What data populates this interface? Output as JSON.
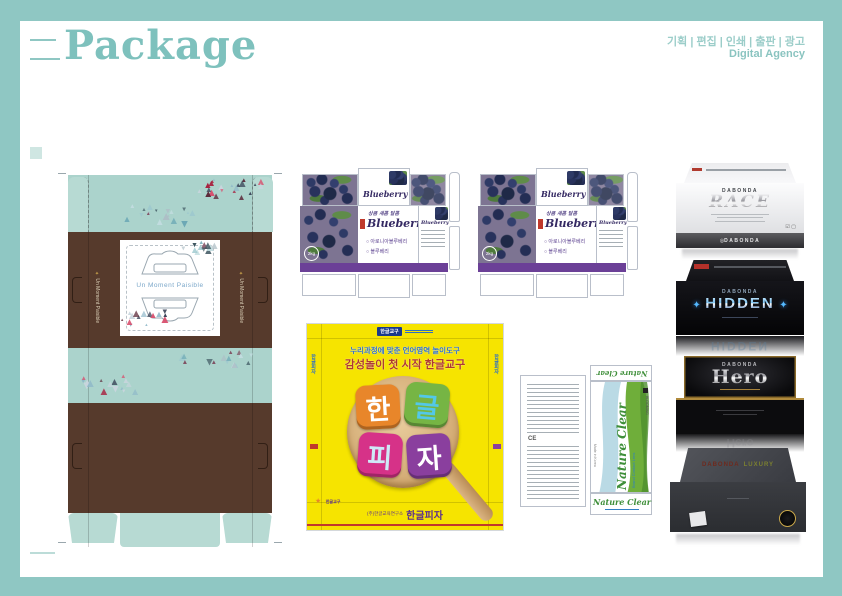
{
  "header": {
    "title": "Package",
    "services": "기획 | 편집 | 인쇄 | 출판 | 광고",
    "agency": "Digital Agency"
  },
  "colors": {
    "frame": "#8fc7c3",
    "title": "#7ec1bd",
    "brown": "#563a2c",
    "teal_panel": "#abd3cc",
    "blueberry_purple": "#6b4097",
    "blueberry_title": "#352a63",
    "yellow": "#f6e400",
    "headline_blue": "#2f6fc4",
    "headline_red": "#b03a2e",
    "footer_purple": "#5c2f8e",
    "nature_green": "#3f8f3a",
    "tri_pink": [
      "#d94f6e",
      "#a8213f",
      "#5c2a3a",
      "#c9d6de",
      "#8fb8c9",
      "#343d52"
    ],
    "tri_teal": [
      "#9ec9cf",
      "#6aa7b5",
      "#3e5660",
      "#c2dde0",
      "#7e4a5e",
      "#aebec6"
    ]
  },
  "tea_box": {
    "window_text": "Un Moment Paisible",
    "side_text": "Un Moment Paisible"
  },
  "blueberry": {
    "tagline": "상큼 새콤 달콤",
    "title": "Blueberry",
    "options": [
      "아로니아블루베리",
      "블루베리"
    ],
    "weight": "2kg"
  },
  "hangul_pizza": {
    "top_logo": "한글교구",
    "headline1": "누리과정에 맞춘 언어영역 놀이도구",
    "headline2": "감성놀이 첫 시작 한글교구",
    "pieces": [
      {
        "char": "한",
        "bg": "#e8862a",
        "fg": "#ffffff"
      },
      {
        "char": "글",
        "bg": "#76b544",
        "fg": "#53c8e8"
      },
      {
        "char": "피",
        "bg": "#d63288",
        "fg": "#cfe9f7"
      },
      {
        "char": "자",
        "bg": "#8a3f9e",
        "fg": "#ffffff"
      }
    ],
    "footer_small": "(주)한글교육연구소",
    "footer": "한글피자",
    "side_text": "한글피자"
  },
  "nature_clear": {
    "title": "Nature Clear",
    "subtitle": "Brand Contact Lens",
    "ce": "CE",
    "origin": "Made in Korea",
    "maker": "BLOOMING"
  },
  "product_boxes": [
    {
      "brand": "DABONDA",
      "title": "RACE"
    },
    {
      "brand": "DABONDA",
      "title": "HIDDEN"
    },
    {
      "brand": "DABONDA",
      "title": "Hero"
    },
    {
      "brand": "DABONDA",
      "title": "LUXURY"
    }
  ]
}
